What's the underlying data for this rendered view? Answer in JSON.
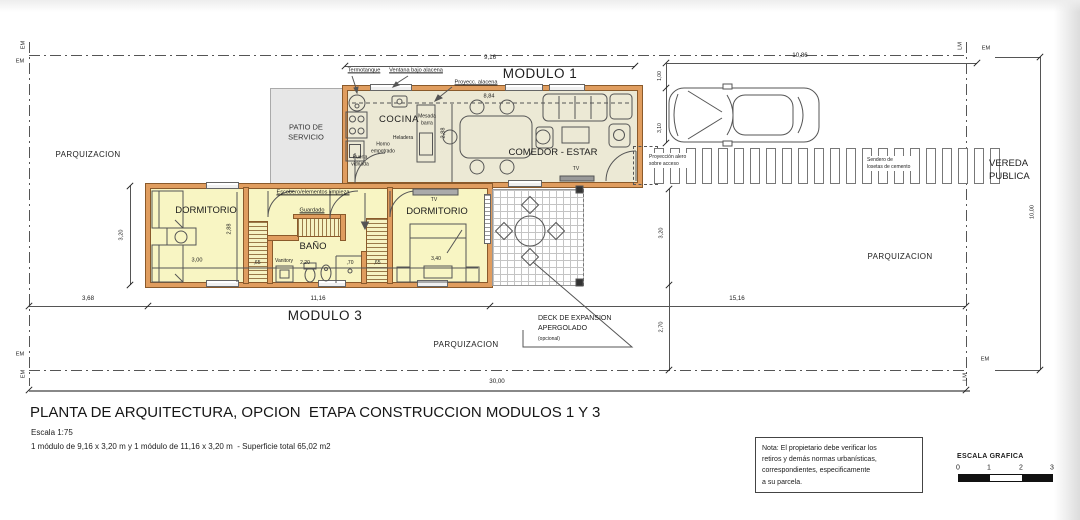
{
  "plan": {
    "modulo1": "MODULO 1",
    "modulo3": "MODULO 3",
    "rooms": {
      "cocina": "COCINA",
      "comedor": "COMEDOR - ESTAR",
      "patio": "PATIO DE\nSERVICIO",
      "dormitorio1": "DORMITORIO",
      "dormitorio2": "DORMITORIO",
      "bano": "BAÑO",
      "tv1": "TV",
      "tv2": "TV"
    },
    "fixtures": {
      "termotanque": "Termotanque",
      "ventana_bajo_alacena": "Ventana bajo alacena",
      "proyecc_alacena": "Proyecc. alacena",
      "mesada_barra": "Mesada\nbarra",
      "horno_empotrado": "Horno\nempotrado",
      "heladera": "Heladera",
      "puerta_vidriada": "Puerta\nvidriada",
      "escobero": "Escobero/elementos limpieza",
      "guardado": "Guardado",
      "vanitory": "Vanitory"
    },
    "site": {
      "parquizacion": "PARQUIZACION",
      "vereda_publica": "VEREDA\nPUBLICA",
      "sendero": "Sendero de\nlosetas de cemento",
      "proyeccion_alero": "Proyección alero\nsobre acceso",
      "deck": "DECK DE EXPANSION\nAPERGOLADO",
      "deck_opcional": "(opcional)"
    },
    "markers": {
      "em": "EM",
      "lm": "LM"
    },
    "dims": {
      "v916": "9,16",
      "v1086": "10,86",
      "v100": "1,00",
      "v310": "3,10",
      "v884": "8,84",
      "v288": "2,88",
      "v320": "3,20",
      "v300": "3,00",
      "v65": ",65",
      "v220": "2,20",
      "v70": ",70",
      "v340": "3,40",
      "v368": "3,68",
      "v1116": "11,16",
      "v1516": "15,16",
      "v270": "2,70",
      "v3000": "30,00",
      "v1000": "10,00"
    }
  },
  "title_block": {
    "title": "PLANTA DE ARQUITECTURA, OPCION  ETAPA CONSTRUCCION MODULOS 1 Y 3",
    "scale": "Escala 1:75",
    "modules": "1 módulo de 9,16 x 3,20 m y 1 módulo de 11,16 x 3,20 m  - Superficie total 65,02 m2"
  },
  "note": "Nota: El propietario debe verificar los\nretiros y demás normas urbanísticas,\ncorrespondientes, especificamente\na su parcela.",
  "scale_bar": {
    "label": "ESCALA GRAFICA",
    "ticks": [
      "0",
      "1",
      "2",
      "3"
    ]
  }
}
